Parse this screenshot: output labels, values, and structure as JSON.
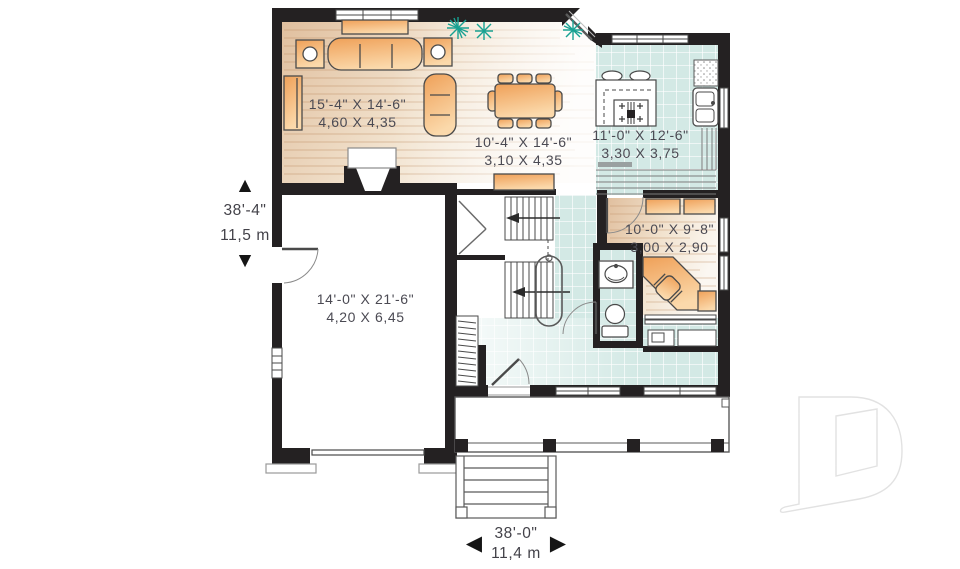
{
  "rooms": [
    {
      "id": "living-room",
      "imperial": "15'-4\" X 14'-6\"",
      "metric": "4,60 X 4,35"
    },
    {
      "id": "dining-room",
      "imperial": "10'-4\" X 14'-6\"",
      "metric": "3,10 X 4,35"
    },
    {
      "id": "kitchen",
      "imperial": "11'-0\" X 12'-6\"",
      "metric": "3,30 X 3,75"
    },
    {
      "id": "den",
      "imperial": "10'-0\" X 9'-8\"",
      "metric": "3,00 X 2,90"
    },
    {
      "id": "garage",
      "imperial": "14'-0\" X 21'-6\"",
      "metric": "4,20 X 6,45"
    }
  ],
  "overall": {
    "depth": {
      "imperial": "38'-4\"",
      "metric": "11,5 m"
    },
    "width": {
      "imperial": "38'-0\"",
      "metric": "11,4 m"
    }
  },
  "icons": {
    "up_arrow": "▲",
    "down_arrow": "▼",
    "left_arrow": "◀",
    "right_arrow": "▶"
  },
  "colors": {
    "wall": "#242122",
    "wood_floor": "#e2c3a2",
    "tile_floor": "#d3e9e5",
    "furniture": "#f0a159",
    "plant": "#18a192",
    "label_text": "#4b4a53",
    "watermark": "#e2e2e2"
  }
}
